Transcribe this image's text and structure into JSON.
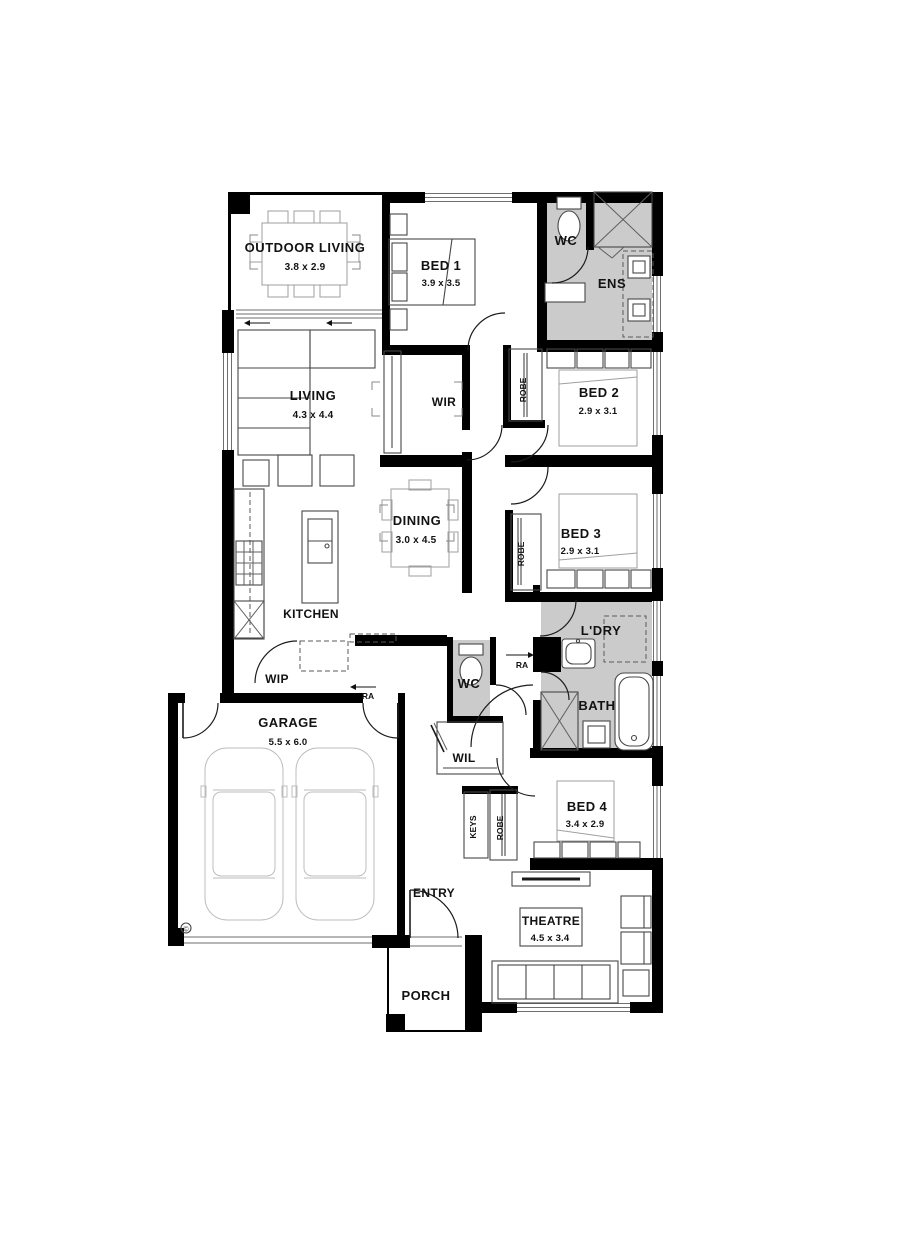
{
  "rooms": {
    "outdoor_living": {
      "name": "OUTDOOR LIVING",
      "dims": "3.8 x 2.9"
    },
    "bed1": {
      "name": "BED 1",
      "dims": "3.9 x 3.5"
    },
    "ens_wc": {
      "name": "WC"
    },
    "ens": {
      "name": "ENS"
    },
    "living": {
      "name": "LIVING",
      "dims": "4.3 x 4.4"
    },
    "wir": {
      "name": "WIR"
    },
    "bed2": {
      "name": "BED 2",
      "dims": "2.9 x 3.1"
    },
    "bed2_robe": {
      "name": "ROBE"
    },
    "dining": {
      "name": "DINING",
      "dims": "3.0 x 4.5"
    },
    "bed3": {
      "name": "BED 3",
      "dims": "2.9 x 3.1"
    },
    "bed3_robe": {
      "name": "ROBE"
    },
    "kitchen": {
      "name": "KITCHEN"
    },
    "laundry": {
      "name": "L'DRY"
    },
    "wip": {
      "name": "WIP"
    },
    "hall_wc": {
      "name": "WC"
    },
    "bath": {
      "name": "BATH"
    },
    "garage": {
      "name": "GARAGE",
      "dims": "5.5 x 6.0"
    },
    "wil": {
      "name": "WIL"
    },
    "keys": {
      "name": "KEYS"
    },
    "bed4_robe": {
      "name": "ROBE"
    },
    "bed4": {
      "name": "BED 4",
      "dims": "3.4 x 2.9"
    },
    "entry": {
      "name": "ENTRY"
    },
    "theatre": {
      "name": "THEATRE",
      "dims": "4.5 x 3.4"
    },
    "porch": {
      "name": "PORCH"
    }
  },
  "annotations": {
    "return_air_1": "RA",
    "return_air_2": "RA",
    "copyright_symbol": "©"
  },
  "colors": {
    "wall": "#000000",
    "wet_area": "#cbcbcb",
    "furniture_line": "#9f9f9f",
    "window_line": "#6e6e6e"
  }
}
